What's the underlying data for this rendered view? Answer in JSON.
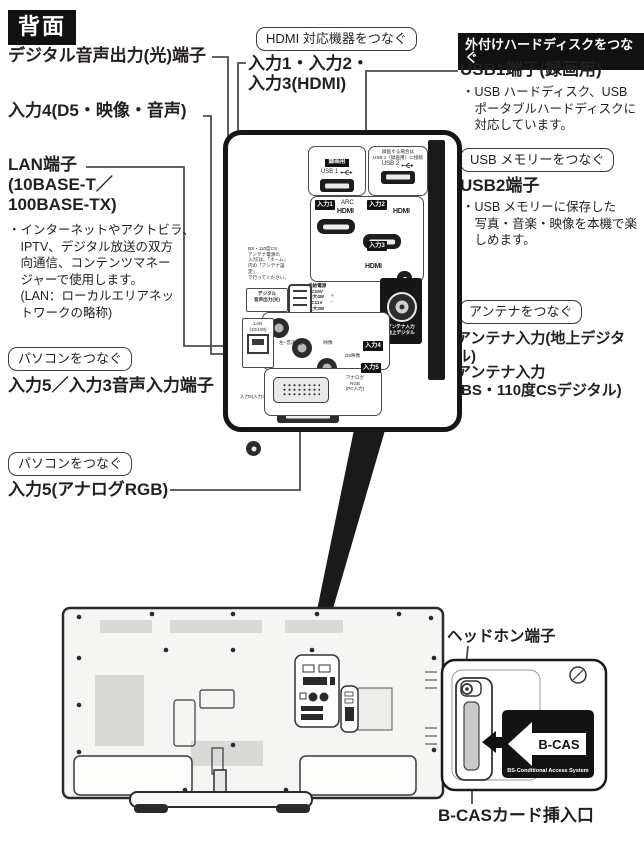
{
  "header": {
    "title": "背面"
  },
  "callouts": {
    "hdmi": "HDMI 対応機器をつなぐ",
    "external_hdd": "外付けハードディスクをつなぐ",
    "usb_memory": "USB メモリーをつなぐ",
    "antenna": "アンテナをつなぐ",
    "pc_top": "パソコンをつなぐ",
    "pc_bottom": "パソコンをつなぐ"
  },
  "labels": {
    "digital_audio_out": "デジタル音声出力(光)端子",
    "input4": "入力4(D5・映像・音声)",
    "lan": "LAN端子\n(10BASE-T／\n100BASE-TX)",
    "lan_desc": "・インターネットやアクトビラ、\n　IPTV、デジタル放送の双方\n　向通信、コンテンツマネー\n　ジャーで使用します。\n　(LAN：ローカルエリアネッ\n　トワークの略称)",
    "input123_hdmi": "入力1・入力2・\n入力3(HDMI)",
    "usb1": "USB1端子(録画用)",
    "usb1_desc": "・USB ハードディスク、USB\n　ポータブルハードディスクに\n　対応しています。",
    "usb2": "USB2端子",
    "usb2_desc": "・USB メモリーに保存した\n　写真・音楽・映像を本機で楽\n　しめます。",
    "input5_audio": "入力5／入力3音声入力端子",
    "input5_rgb": "入力5(アナログRGB)",
    "antenna_terrestrial": "アンテナ入力(地上デジタル)",
    "antenna_bs": "アンテナ入力\n(BS・110度CSデジタル)",
    "headphone": "ヘッドホン端子",
    "bcas_slot": "B-CASカード挿入口"
  },
  "panel": {
    "usb1_badge": "録画用",
    "usb1_port_label": "USB 1",
    "usb2_note": "録画する場合は\nUSB 1（録画用）に接続",
    "usb2_port_label": "USB 2",
    "inputs": {
      "in1": "入力1",
      "in2": "入力2",
      "in3": "入力3",
      "in4": "入力4",
      "in5": "入力5"
    },
    "arc": "ARC",
    "hdmi_logo": "HDMI",
    "bs_power_note": "BS・110度CS\nアンテナ電源の\n入/切は、「ホーム」\n内の「アンテナ設定」\nで行ってください。",
    "supply_note": "供給電源\nDC15V\n最大4W\nDC11V\n最大3W",
    "plus_minus": "＋\n−",
    "digital_out": "デジタル\n音声出力(光)",
    "antenna_bs_label": "アンテナ入力\nBS・110度CS\nデジタル",
    "antenna_ter_label": "アンテナ入力\n地上デジタル",
    "lan_port": "LAN\n(10/100)",
    "av_audio_caption": "左−音声−右",
    "av_video_caption": "映像",
    "d_terminal": "D5映像",
    "vga_label": "アナログ\nRGB\n(PC入力)",
    "minijack_caption": "入力5(入力3) 音声入力"
  },
  "inset": {
    "card_title": "B-CAS",
    "card_sub": "BS-Conditional Access System"
  }
}
